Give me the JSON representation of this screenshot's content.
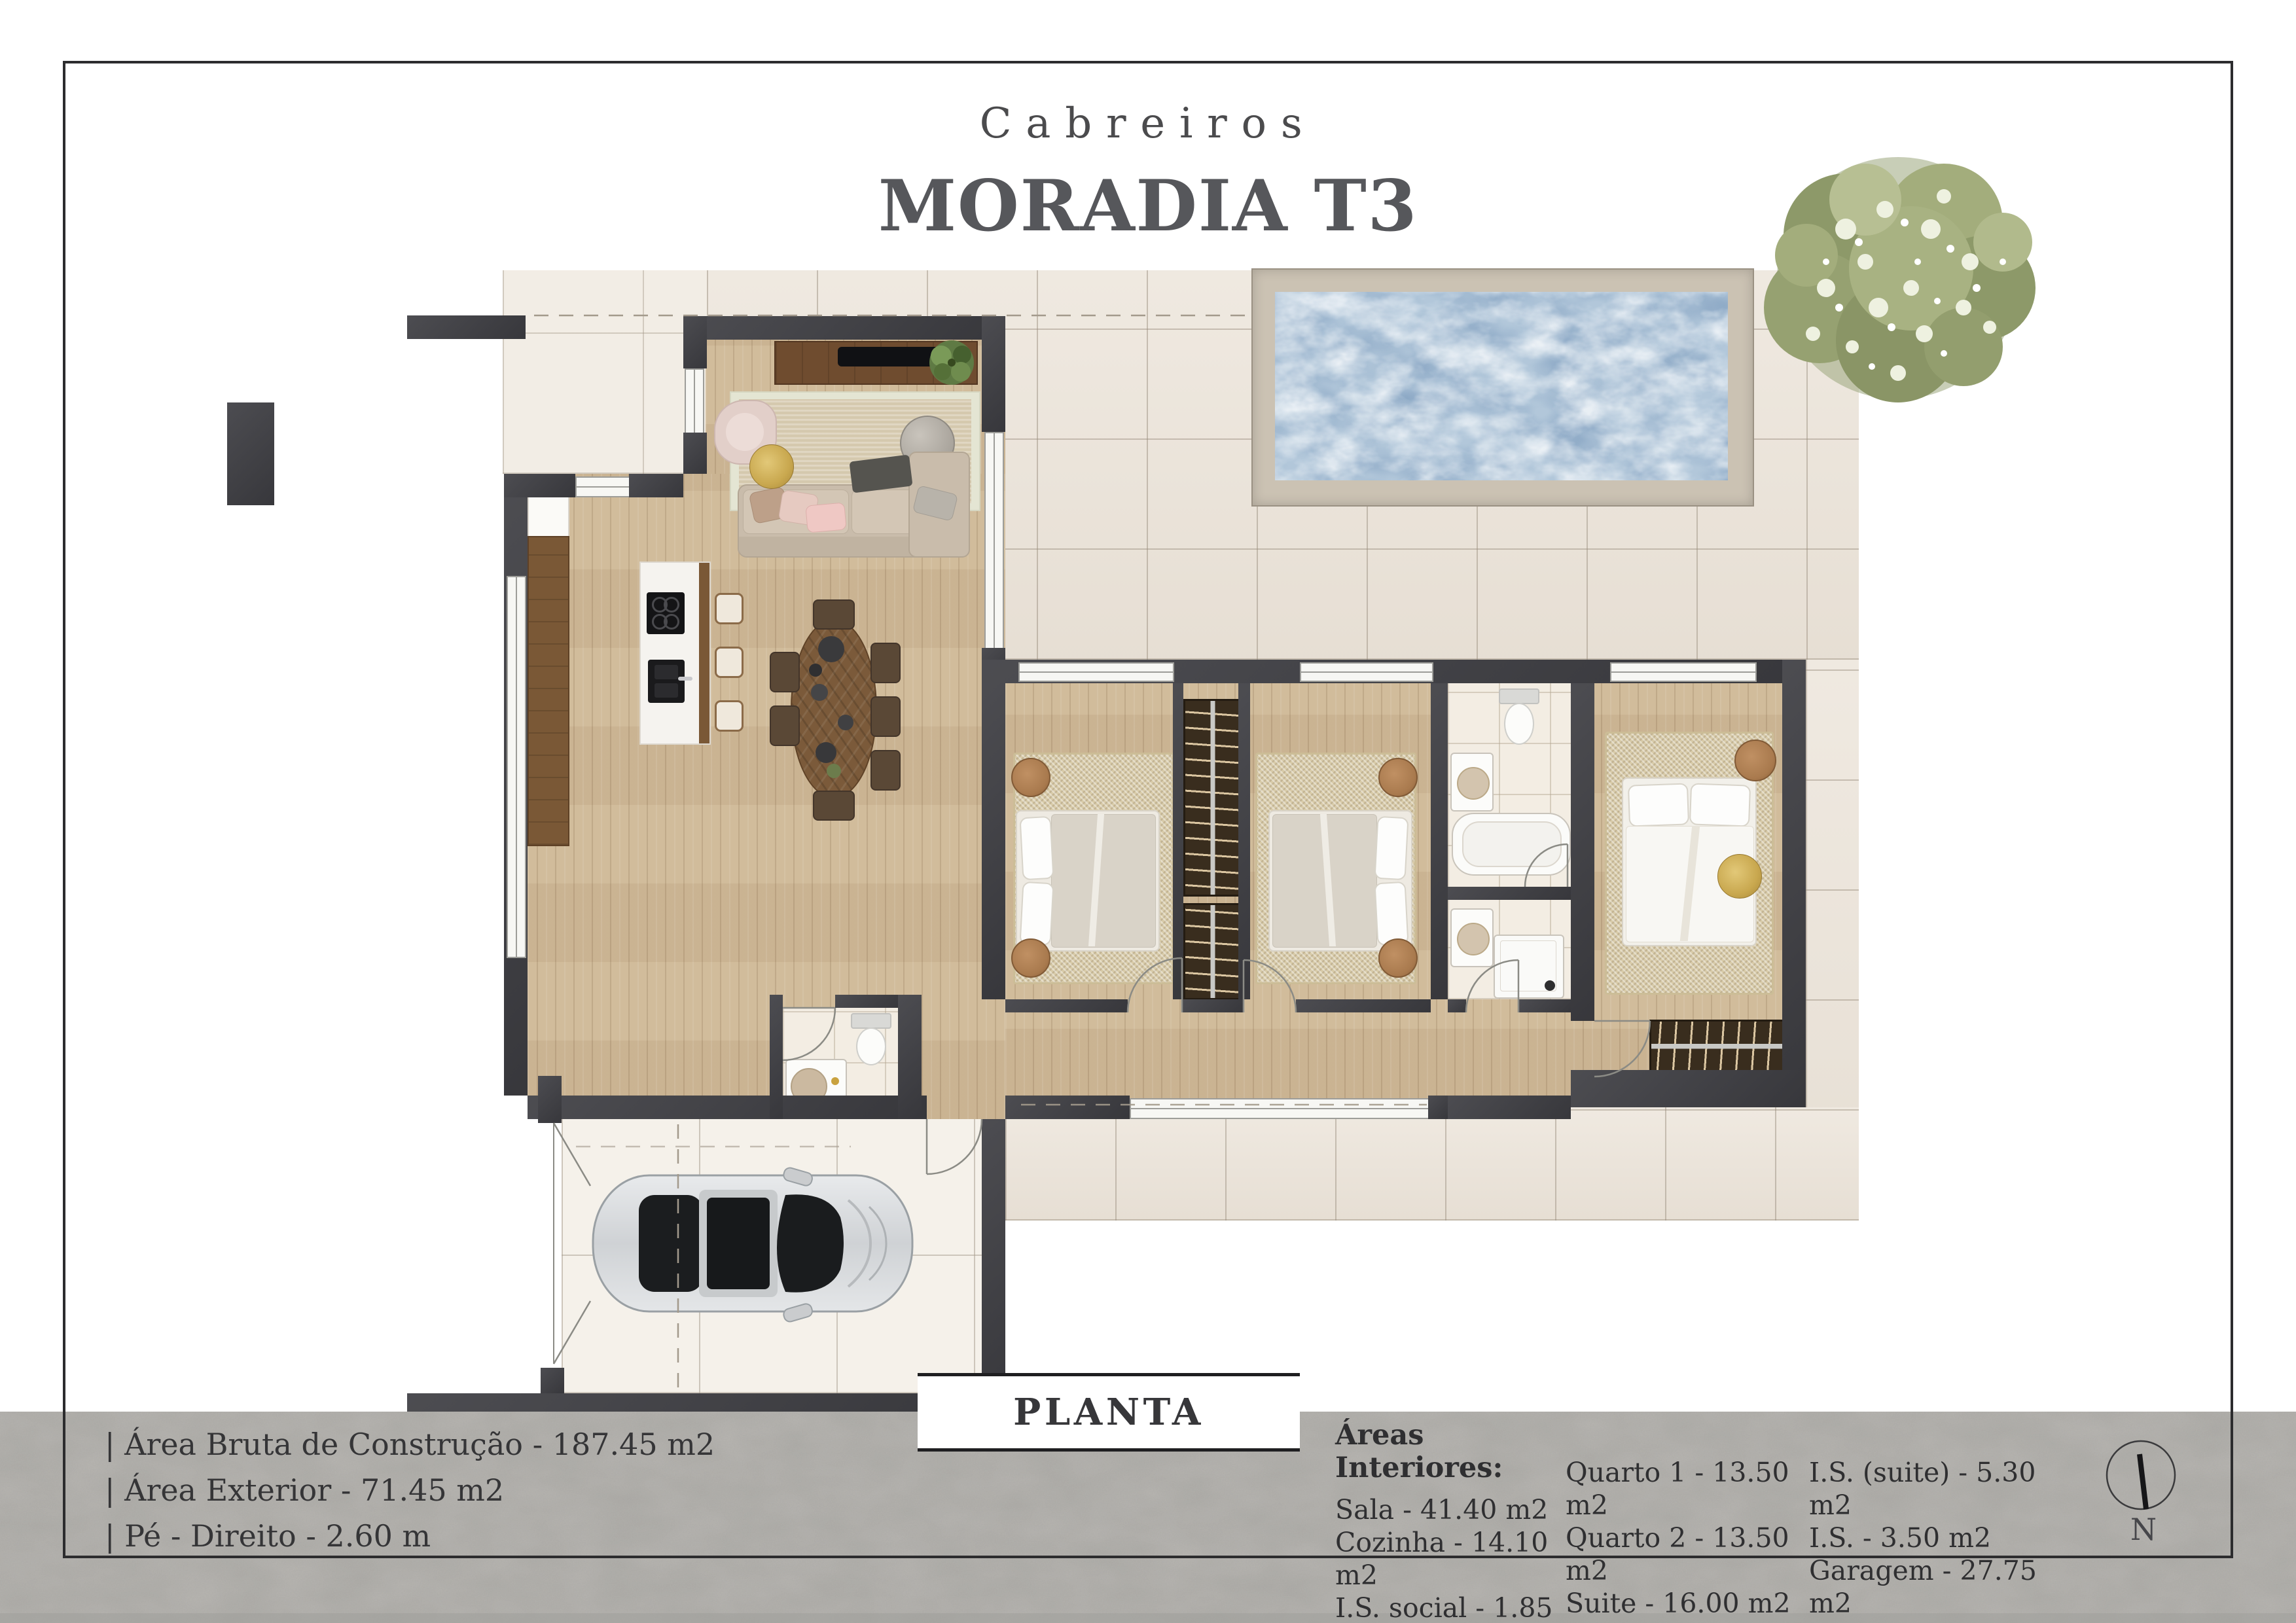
{
  "header": {
    "estate": "Cabreiros",
    "title": "MORADIA T3"
  },
  "plan_label": "PLANTA",
  "specs": {
    "line1": "| Área Bruta de Construção - 187.45 m2",
    "line2": "| Área Exterior - 71.45 m2",
    "line3": "| Pé - Direito - 2.60 m"
  },
  "areas": {
    "heading": "Áreas Interiores:",
    "col1": [
      "Sala - 41.40 m2",
      "Cozinha - 14.10 m2",
      "I.S. social - 1.85 m2"
    ],
    "col2": [
      "Quarto 1 - 13.50 m2",
      "Quarto 2 - 13.50 m2",
      "Suite - 16.00 m2"
    ],
    "col3": [
      "I.S. (suite) - 5.30 m2",
      "I.S. - 3.50 m2",
      "Garagem - 27.75 m2"
    ]
  },
  "compass": {
    "label": "N"
  },
  "colors": {
    "wall": "#3f3f44",
    "wood_floor": "#cfb997",
    "deck_tile": "#ebe3d8",
    "pool_water": "#aac3d6",
    "pool_coping": "#cbc2b3",
    "concrete_band": "#bab8b4",
    "title_text": "#56575b",
    "accent_gold": "#c9a84f",
    "wardrobe": "#392d1e"
  }
}
